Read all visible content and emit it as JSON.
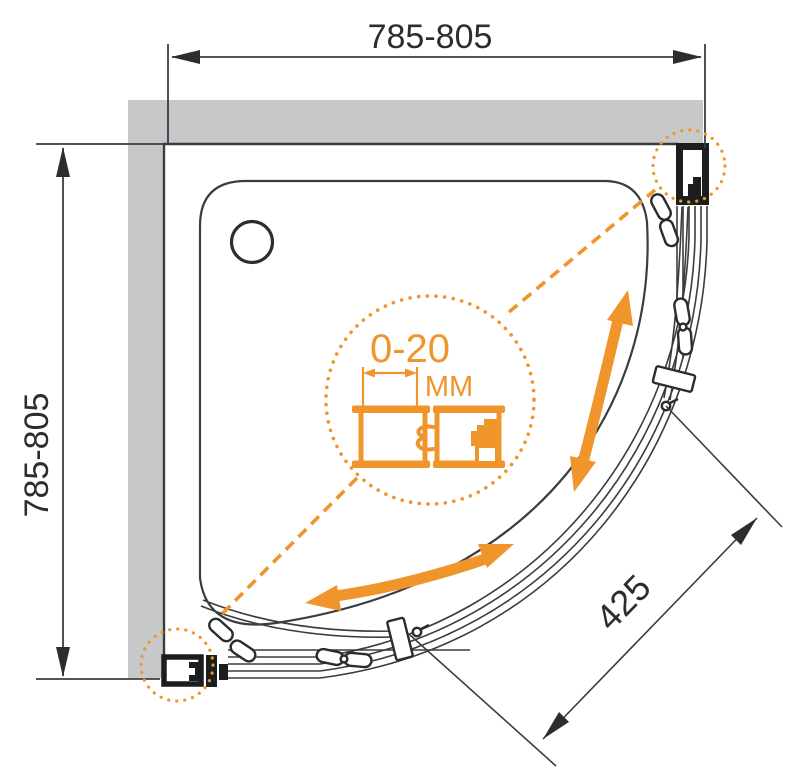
{
  "labels": {
    "width_dimension": "785-805",
    "depth_dimension": "785-805",
    "entry_dimension": "425",
    "adjustment_range": "0-20",
    "adjustment_unit": "MM"
  },
  "colors": {
    "accent": "#F0952C",
    "wall": "#C6C8CA",
    "line": "#3A3D3F",
    "dark": "#1B1D1F",
    "background": "#FFFFFF"
  }
}
